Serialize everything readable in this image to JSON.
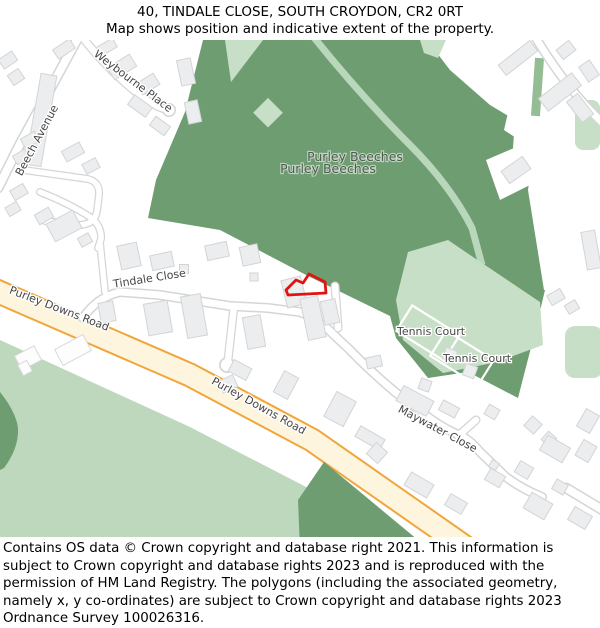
{
  "header": {
    "title": "40, TINDALE CLOSE, SOUTH CROYDON, CR2 0RT",
    "subtitle": "Map shows position and indicative extent of the property."
  },
  "map": {
    "labels": {
      "beech_avenue": "Beech Avenue",
      "weybourne_place": "Weybourne Place",
      "tindale_close": "Tindale Close",
      "purley_beeches": "Purley Beeches",
      "purley_downs_road": "Purley Downs Road",
      "tennis_court": "Tennis Court",
      "maywater_close": "Maywater Close"
    },
    "colors": {
      "forest_green": "#6f9d72",
      "open_land_green": "#bdd8bc",
      "light_green": "#c7dfc6",
      "road_fill": "#fdf5de",
      "road_border_orange": "#f0a63c",
      "minor_road_border": "#d4d6d6",
      "building_fill": "#ecedee",
      "building_border": "#d2d4d6",
      "property_outline_red": "#e31212"
    }
  },
  "footer": {
    "text": "Contains OS data © Crown copyright and database right 2021. This information is subject to Crown copyright and database rights 2023 and is reproduced with the permission of HM Land Registry. The polygons (including the associated geometry, namely x, y co-ordinates) are subject to Crown copyright and database rights 2023 Ordnance Survey 100026316."
  }
}
